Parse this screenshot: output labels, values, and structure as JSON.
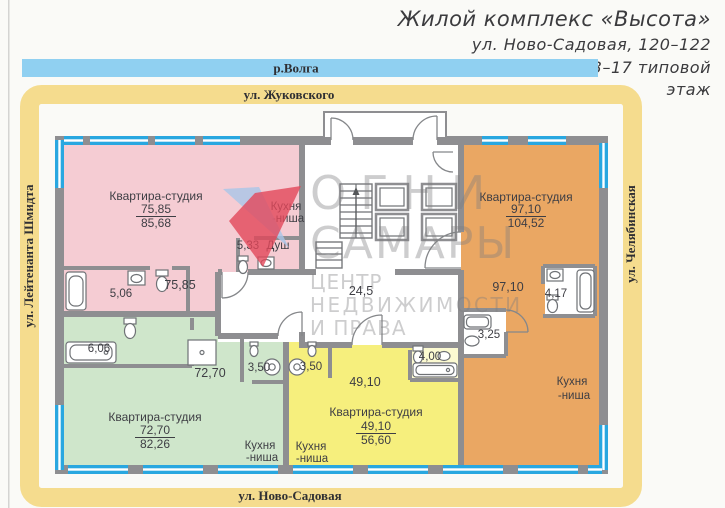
{
  "header": {
    "title": "Жилой комплекс «Высота»",
    "address": "ул. Ново-Садовая, 120–122",
    "floor_line1": "3–17 типовой",
    "floor_line2": "этаж"
  },
  "streets": {
    "river": "р.Волга",
    "top": "ул. Жуковского",
    "bottom": "ул. Ново-Садовая",
    "left": "ул. Лейтенанта Шмидта",
    "right": "ул. Челябинская"
  },
  "apartments": {
    "pink": {
      "name": "Квартира-студия",
      "living_area": "75,85",
      "total_area": "85,68",
      "room_area": "75,85",
      "bath_area": "5,06",
      "shower_area": "5,33",
      "shower_label": "Душ",
      "kitchen_line1": "Кухня",
      "kitchen_line2": "-ниша"
    },
    "green": {
      "name": "Квартира-студия",
      "living_area": "72,70",
      "total_area": "82,26",
      "room_area": "72,70",
      "bath_area": "6,06",
      "hall_area": "3,50",
      "kitchen_line1": "Кухня",
      "kitchen_line2": "-ниша"
    },
    "yellow": {
      "name": "Квартира-студия",
      "living_area": "49,10",
      "total_area": "56,60",
      "room_area": "49,10",
      "hall_area": "3,50",
      "bath_area": "4,00",
      "kitchen_line1": "Кухня",
      "kitchen_line2": "-ниша"
    },
    "orange": {
      "name": "Квартира-студия",
      "living_area": "97,10",
      "total_area": "104,52",
      "room_area": "97,10",
      "bath_area": "4,17",
      "wc_area": "3,25",
      "kitchen_line1": "Кухня",
      "kitchen_line2": "-ниша"
    }
  },
  "common": {
    "corridor_area": "24,5"
  },
  "watermark": {
    "line1": "ОГНИ",
    "line2": "САМАРЫ",
    "line3": "ЦЕНТР",
    "line4": "НЕДВИЖИМОСТИ",
    "line5": "И ПРАВА"
  },
  "colors": {
    "pink": "#f5ccd3",
    "green": "#cfe6cb",
    "yellow": "#f6ef7d",
    "orange": "#eaa763",
    "wall": "#8e8e91",
    "window": "#29a7e0",
    "frame_yellow": "#f5dc8e",
    "river_blue": "#90d0f1",
    "logo_red": "#e2475a",
    "logo_blue": "#a9c6e8",
    "text": "#3e3e44"
  }
}
